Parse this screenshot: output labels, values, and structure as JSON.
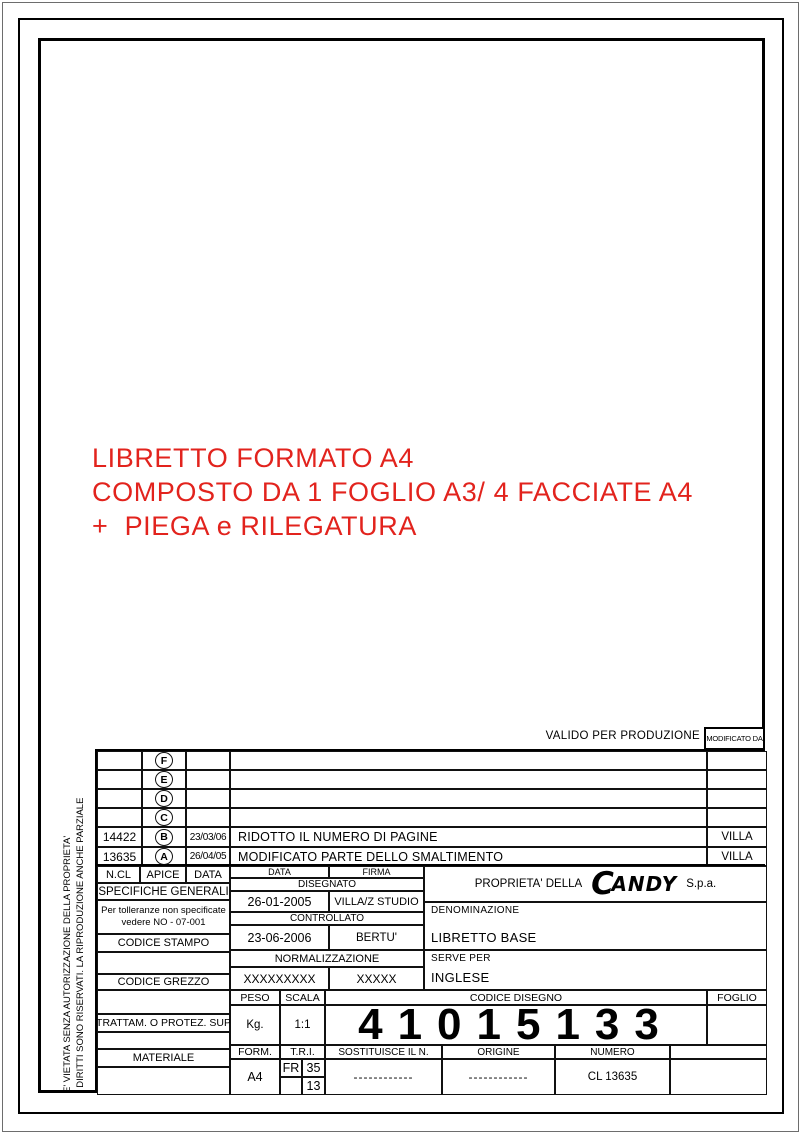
{
  "note": {
    "color": "#e2231d",
    "lines": [
      "LIBRETTO FORMATO A4",
      "COMPOSTO DA 1 FOGLIO A3/ 4 FACCIATE A4",
      "+  PIEGA e RILEGATURA"
    ]
  },
  "banner": {
    "valido": "VALIDO PER PRODUZIONE",
    "modificato_da": "MODIFICATO DA"
  },
  "revision_table": {
    "rows": [
      {
        "code": "",
        "apex": "F",
        "date": "",
        "description": "",
        "modified_by": ""
      },
      {
        "code": "",
        "apex": "E",
        "date": "",
        "description": "",
        "modified_by": ""
      },
      {
        "code": "",
        "apex": "D",
        "date": "",
        "description": "",
        "modified_by": ""
      },
      {
        "code": "",
        "apex": "C",
        "date": "",
        "description": "",
        "modified_by": ""
      },
      {
        "code": "14422",
        "apex": "B",
        "date": "23/03/06",
        "description": "RIDOTTO IL NUMERO DI PAGINE",
        "modified_by": "VILLA"
      },
      {
        "code": "13635",
        "apex": "A",
        "date": "26/04/05",
        "description": "MODIFICATO PARTE DELLO SMALTIMENTO",
        "modified_by": "VILLA"
      }
    ]
  },
  "title_block": {
    "left": {
      "ncl": "N.CL",
      "apice": "APICE",
      "data": "DATA",
      "specifiche": "SPECIFICHE GENERALI",
      "tolleranze_1": "Per tolleranze non specificate",
      "tolleranze_2": "vedere NO - 07-001",
      "codice_stampo": "CODICE STAMPO",
      "codice_grezzo": "CODICE GREZZO",
      "trattamento": "TRATTAM. O PROTEZ. SUP",
      "materiale": "MATERIALE"
    },
    "firme": {
      "data": "DATA",
      "firma": "FIRMA",
      "disegnato": "DISEGNATO",
      "disegnato_data": "26-01-2005",
      "disegnato_firma": "VILLA/Z STUDIO",
      "controllato": "CONTROLLATO",
      "controllato_data": "23-06-2006",
      "controllato_firma": "BERTU'",
      "normalizzazione": "NORMALIZZAZIONE",
      "normalizzazione_data": "XXXXXXXXX",
      "normalizzazione_firma": "XXXXX"
    },
    "company": {
      "proprieta": "PROPRIETA' DELLA",
      "logo_c": "C",
      "logo_rest": "ANDY",
      "suffix": "S.p.a."
    },
    "denominazione": {
      "label": "DENOMINAZIONE",
      "value": "LIBRETTO BASE"
    },
    "serve_per": {
      "label": "SERVE PER",
      "value": "INGLESE"
    },
    "peso": {
      "label": "PESO",
      "value": "Kg."
    },
    "scala": {
      "label": "SCALA",
      "value": "1:1"
    },
    "formato": {
      "label": "FORM.",
      "value": "A4"
    },
    "tri": {
      "label": "T.R.I.",
      "fr": "FR",
      "sopra": "35",
      "sotto": "13"
    },
    "codice_disegno": {
      "label": "CODICE DISEGNO",
      "value": "41015133"
    },
    "foglio": {
      "label": "FOGLIO",
      "value": ""
    },
    "sostituisce": {
      "label": "SOSTITUISCE IL N.",
      "value": "------------"
    },
    "origine": {
      "label": "ORIGINE",
      "value": "------------"
    },
    "numero": {
      "label": "NUMERO",
      "value": "CL 13635"
    }
  },
  "copyright": {
    "line_outer": "E' VIETATA SENZA AUTORIZZAZIONE DELLA PROPRIETA'",
    "line_inner": "I DIRITTI SONO RISERVATI. LA RIPRODUZIONE ANCHE PARZIALE"
  }
}
